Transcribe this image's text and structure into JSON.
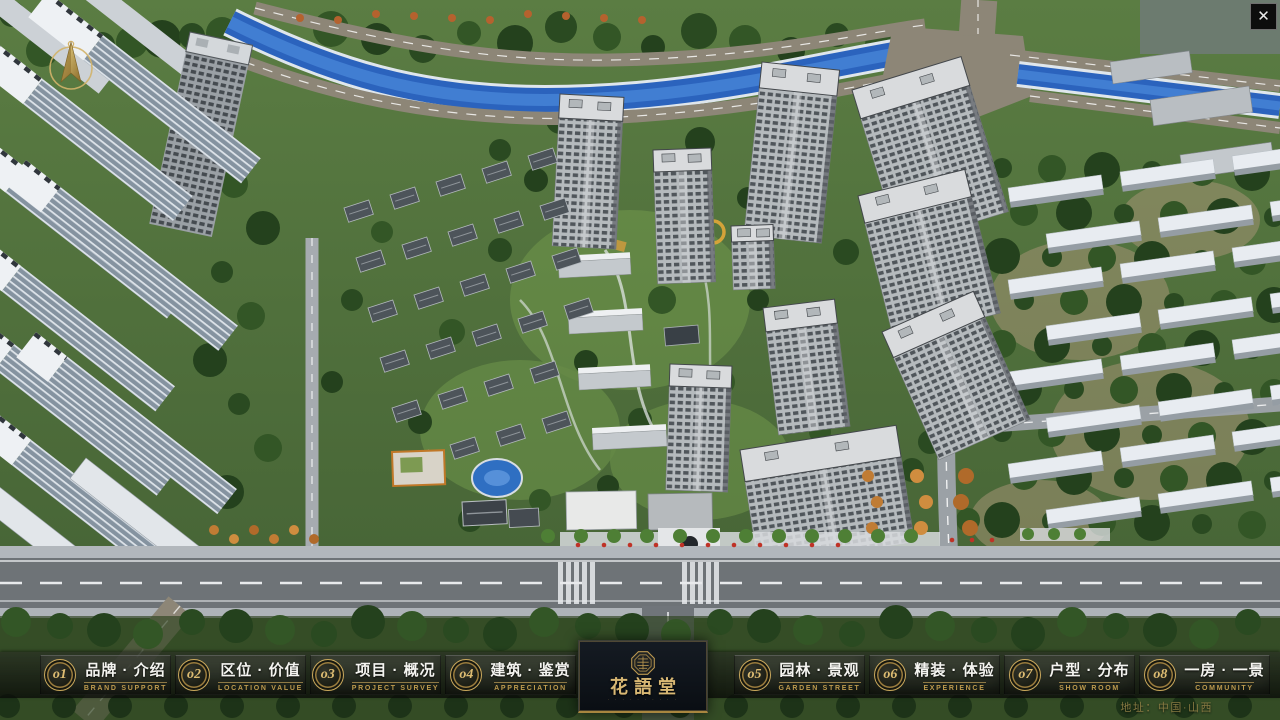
{
  "app": {
    "close_label": "✕",
    "address": "地址：中国·山西"
  },
  "logo": {
    "title": "花語堂",
    "caption": "· · · · · · · · · ·",
    "seal_icon": "octagon-seal"
  },
  "menu": {
    "items": [
      {
        "num": "o1",
        "label": "品牌 · 介绍",
        "sub": "BRAND SUPPORT"
      },
      {
        "num": "o2",
        "label": "区位 · 价值",
        "sub": "LOCATION VALUE"
      },
      {
        "num": "o3",
        "label": "项目 · 概况",
        "sub": "PROJECT SURVEY"
      },
      {
        "num": "o4",
        "label": "建筑 · 鉴赏",
        "sub": "APPRECIATION"
      },
      {
        "num": "o5",
        "label": "园林 · 景观",
        "sub": "GARDEN STREET"
      },
      {
        "num": "o6",
        "label": "精装 · 体验",
        "sub": "EXPERIENCE"
      },
      {
        "num": "o7",
        "label": "户型 · 分布",
        "sub": "SHOW ROOM"
      },
      {
        "num": "o8",
        "label": "一房 · 一景",
        "sub": "COMMUNITY"
      }
    ]
  },
  "icons": {
    "compass": "compass-north-arrow"
  },
  "colors": {
    "gold": "#c9a85c",
    "bar_background": "#14160f",
    "river_blue": "#2b63bd"
  }
}
